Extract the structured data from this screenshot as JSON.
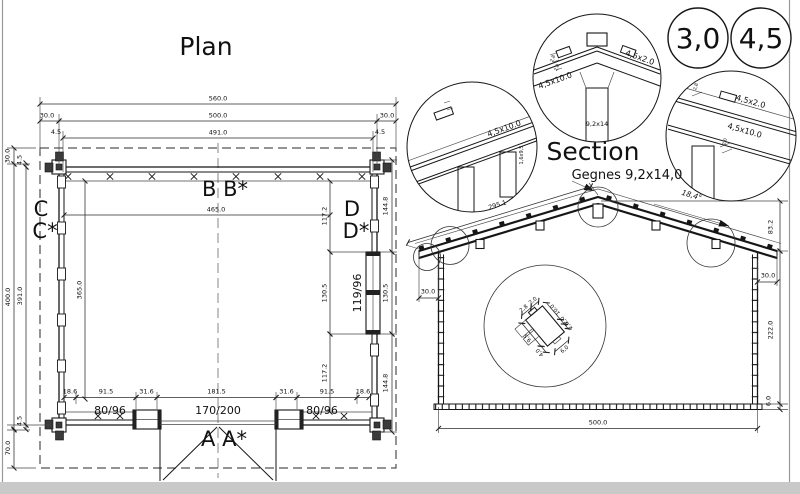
{
  "frame": {
    "border_color": "#9a9a9a",
    "bottom_bar_color": "#c9c9c9",
    "background": "#ffffff"
  },
  "plan": {
    "title": "Plan",
    "dims": {
      "top_overall": "560.0",
      "top_wall": "500.0",
      "top_inner": "491.0",
      "top_overhang_left": "30.0",
      "top_overhang_right": "30.0",
      "top_log_left": "4.5",
      "top_log_right": "4.5",
      "left_overall": "400.0",
      "left_wall": "391.0",
      "left_inner": "365.0",
      "left_overhang_top": "30.0",
      "left_log_top": "4.5",
      "left_log_bottom": "4.5",
      "left_overhang_bottom": "70.0",
      "inner_width": "465.0",
      "right_inner": [
        "117.2",
        "130.5",
        "117.2"
      ],
      "right_outer": [
        "144.8",
        "130.5",
        "144.8"
      ],
      "bottom": [
        "18.6",
        "91.5",
        "31.6",
        "181.5",
        "31.6",
        "91.5",
        "18.6"
      ]
    },
    "openings": {
      "window_left": "80/96",
      "door": "170/200",
      "window_right": "80/96",
      "window_side": "119/96"
    },
    "markers": {
      "a": "A A*",
      "b": "B B*",
      "c1": "C",
      "c2": "C*",
      "d1": "D",
      "d2": "D*"
    }
  },
  "section": {
    "title": "Section",
    "ridge_note": "Gegnes 9,2x14,0",
    "dims": {
      "roof_slope": "295.1",
      "roof_angle": "18,4°",
      "gable_height": "83.2",
      "overhang_left": "30.0",
      "overhang_right": "30.0",
      "wall_height": "222.0",
      "floor_height": "6.0",
      "width": "500.0"
    },
    "log_profile": {
      "tongue_width": "2,8",
      "tongue_side": "2,0",
      "log_height": "10.0",
      "step1": "2,0",
      "step2": "2,0",
      "log_back": "9,5",
      "bottom_step": "4,0",
      "log_width": "6,0"
    }
  },
  "details": {
    "thickness_badges": [
      "3,0",
      "4,5"
    ],
    "eave": {
      "rafter": "4,5x10.0",
      "wall_log": "1,6x9,5"
    },
    "ridge": {
      "rafter": "4,5x10.0",
      "batten": "4,5x2.0",
      "beam": "9,2x14",
      "dim1": "2,8",
      "dim2": "2,0"
    },
    "slope": {
      "batten": "4,5x2.0",
      "rafter": "4,5x10.0",
      "dim1": "2,8",
      "dim2": "2,0"
    }
  }
}
